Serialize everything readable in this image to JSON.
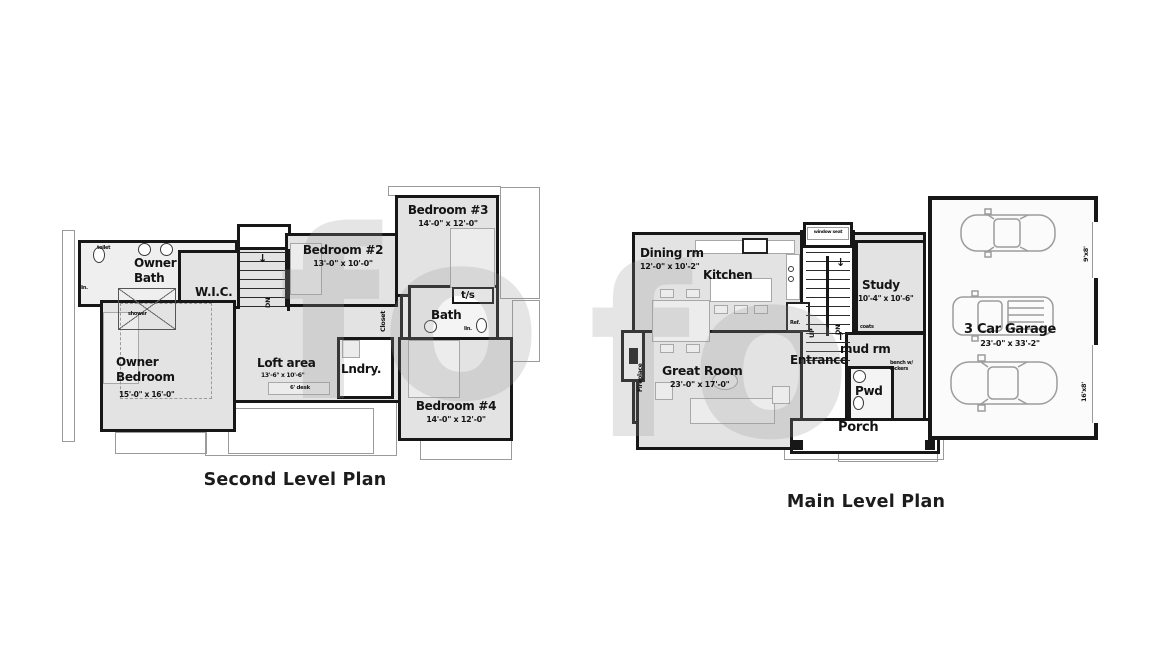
{
  "watermark": {
    "text": "fo"
  },
  "colors": {
    "wall": "#171717",
    "room_fill": "#e3e3e3"
  },
  "second_level": {
    "title": "Second Level Plan",
    "rooms": {
      "owner_bath": {
        "name": "Owner Bath"
      },
      "wic": {
        "name": "W.I.C."
      },
      "owner_bedroom": {
        "name": "Owner Bedroom",
        "dims": "15'-0\" x 16'-0\""
      },
      "bedroom2": {
        "name": "Bedroom #2",
        "dims": "13'-0\" x 10'-0\""
      },
      "bedroom3": {
        "name": "Bedroom #3",
        "dims": "14'-0\" x 12'-0\""
      },
      "bedroom4": {
        "name": "Bedroom #4",
        "dims": "14'-0\" x 12'-0\""
      },
      "bath": {
        "name": "Bath"
      },
      "loft": {
        "name": "Loft area",
        "dims": "13'-6\" x 10'-6\""
      },
      "laundry": {
        "name": "Lndry."
      }
    },
    "labels": {
      "toilet": "toilet",
      "linen": "lin.",
      "shower": "shower",
      "closet": "Closet",
      "tub_shower": "t/s",
      "linen2": "lin.",
      "down": "DN",
      "desk": "6' desk",
      "arrow_down": "↓"
    }
  },
  "main_level": {
    "title": "Main Level Plan",
    "rooms": {
      "dining": {
        "name": "Dining rm",
        "dims": "12'-0\" x 10'-2\""
      },
      "kitchen": {
        "name": "Kitchen"
      },
      "study": {
        "name": "Study",
        "dims": "10'-4\" x 10'-6\""
      },
      "great_room": {
        "name": "Great Room",
        "dims": "23'-0\" x 17'-0\""
      },
      "entrance": {
        "name": "Entrance"
      },
      "mud_room": {
        "name": "mud rm"
      },
      "powder": {
        "name": "Pwd"
      },
      "porch": {
        "name": "Porch"
      },
      "garage": {
        "name": "3 Car Garage",
        "dims": "23'-0\" x 33'-2\""
      }
    },
    "labels": {
      "window_seat": "window seat",
      "fireplace": "Fireplace",
      "ref": "Ref.",
      "up": "UP",
      "down": "DN",
      "coats": "coats",
      "bench": "bench w/ lockers",
      "door_small": "9'x8'",
      "door_large": "16'x8'",
      "arrow_down": "↓",
      "arrow_up": "↑"
    }
  }
}
